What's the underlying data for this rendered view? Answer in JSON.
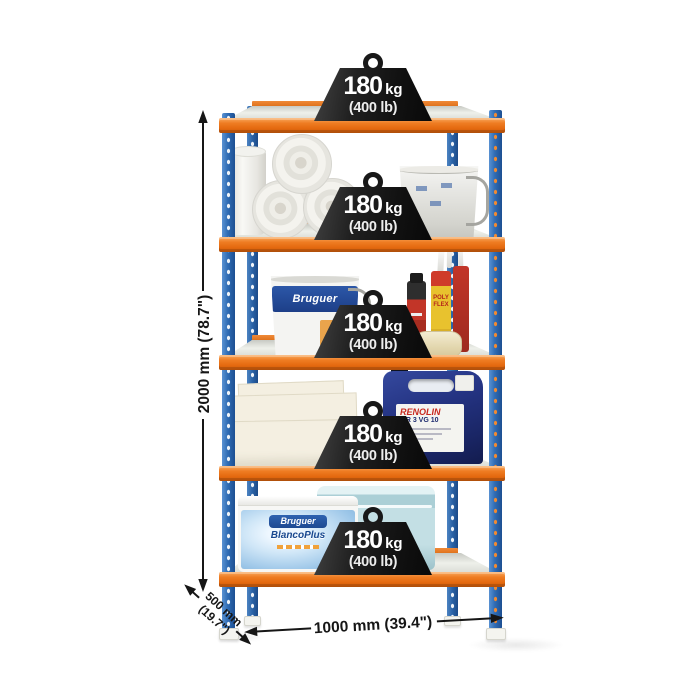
{
  "capacity_badge": {
    "value": "180",
    "unit": "kg",
    "alt": "(400 lb)"
  },
  "dimensions": {
    "height": "2000 mm (78.7\")",
    "width": "1000 mm (39.4\")",
    "depth_line1": "500 mm",
    "depth_line2": "(19.7\")"
  },
  "shelving": {
    "levels": 5,
    "colors": {
      "upright_blue": "#2f6cb4",
      "beam_orange": "#ee7518",
      "deck_galvanized": "#dcdedb",
      "weight_black": "#1b1b1b"
    }
  },
  "products": {
    "paint_bucket_brand": "Bruguer",
    "sealant_tube_label": "POLY FLEX",
    "jerrycan_brand": "RENOLIN",
    "jerrycan_model": "MR 3 VG 10",
    "tub_brand": "Bruguer",
    "tub_product": "BlancoPlus"
  }
}
